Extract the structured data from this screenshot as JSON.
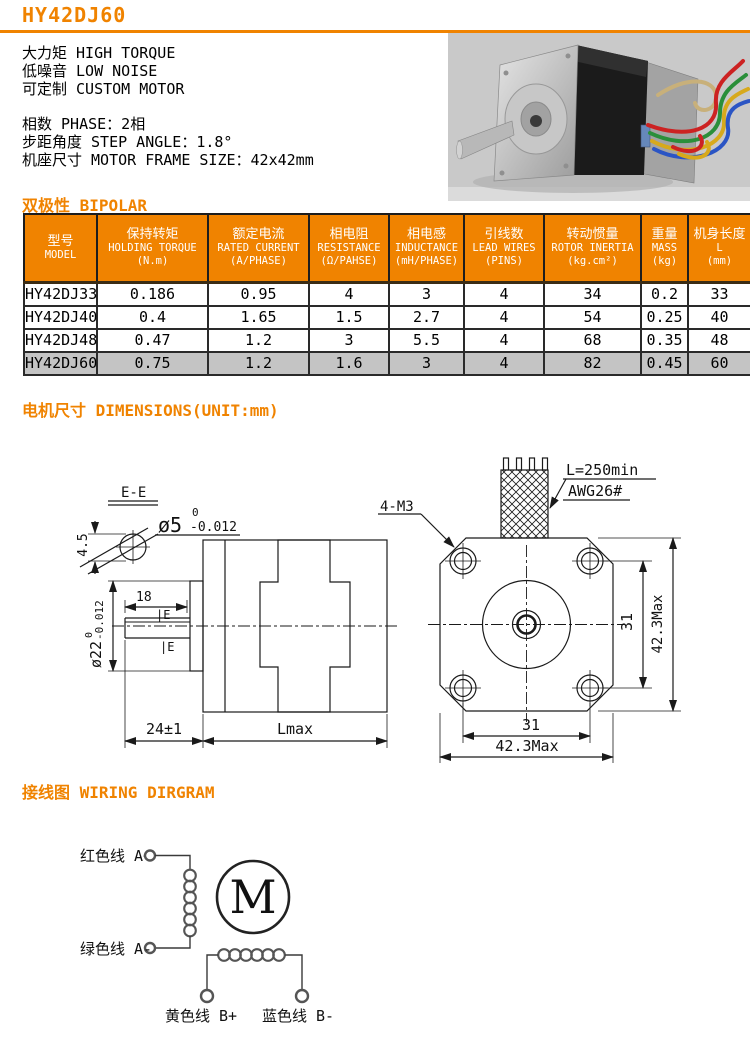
{
  "page": {
    "title": "HY42DJ60"
  },
  "intro": {
    "features": [
      "大力矩 HIGH TORQUE",
      "低噪音 LOW NOISE",
      "可定制 CUSTOM MOTOR"
    ],
    "specs": [
      "相数 PHASE：2相",
      "步距角度 STEP ANGLE：1.8°",
      "机座尺寸 MOTOR FRAME SIZE：42x42mm"
    ]
  },
  "sections": {
    "bipolar": "双极性 BIPOLAR",
    "dimensions": "电机尺寸 DIMENSIONS(UNIT:mm)",
    "wiring": "接线图 WIRING DIRGRAM"
  },
  "spec_table": {
    "columns": [
      {
        "cn": "型号",
        "en": "MODEL",
        "unit": ""
      },
      {
        "cn": "保持转矩",
        "en": "HOLDING TORQUE",
        "unit": "(N.m)"
      },
      {
        "cn": "额定电流",
        "en": "RATED CURRENT",
        "unit": "(A/PHASE)"
      },
      {
        "cn": "相电阻",
        "en": "RESISTANCE",
        "unit": "(Ω/PAHSE)"
      },
      {
        "cn": "相电感",
        "en": "INDUCTANCE",
        "unit": "(mH/PHASE)"
      },
      {
        "cn": "引线数",
        "en": "LEAD WIRES",
        "unit": "(PINS)"
      },
      {
        "cn": "转动惯量",
        "en": "ROTOR INERTIA",
        "unit": "(kg.cm²)"
      },
      {
        "cn": "重量",
        "en": "MASS",
        "unit": "(kg)"
      },
      {
        "cn": "机身长度",
        "en": "L",
        "unit": "(mm)"
      }
    ],
    "rows": [
      {
        "cells": [
          "HY42DJ33",
          "0.186",
          "0.95",
          "4",
          "3",
          "4",
          "34",
          "0.2",
          "33"
        ],
        "highlight": false
      },
      {
        "cells": [
          "HY42DJ40",
          "0.4",
          "1.65",
          "1.5",
          "2.7",
          "4",
          "54",
          "0.25",
          "40"
        ],
        "highlight": false
      },
      {
        "cells": [
          "HY42DJ48",
          "0.47",
          "1.2",
          "3",
          "5.5",
          "4",
          "68",
          "0.35",
          "48"
        ],
        "highlight": false
      },
      {
        "cells": [
          "HY42DJ60",
          "0.75",
          "1.2",
          "1.6",
          "3",
          "4",
          "82",
          "0.45",
          "60"
        ],
        "highlight": true
      }
    ]
  },
  "drawing": {
    "section_label": "E-E",
    "shaft_dia": "ø5",
    "shaft_tol_hi": "0",
    "shaft_tol_lo": "-0.012",
    "flat_height": "4.5",
    "boss_dia": "ø22",
    "boss_tol_hi": "0",
    "boss_tol_lo": "-0.012",
    "flat_length": "18",
    "datum_flag": "|E",
    "shaft_length": "24±1",
    "body_length": "Lmax",
    "mount_holes": "4-M3",
    "lead_length": "L=250min",
    "lead_gauge": "AWG26#",
    "hole_pitch": "31",
    "frame_size": "42.3Max"
  },
  "wiring": {
    "phase_a_pos": "红色线 A+",
    "phase_a_neg": "绿色线 A-",
    "phase_b_pos": "黄色线 B+",
    "phase_b_neg": "蓝色线 B-",
    "motor_symbol": "M"
  },
  "colors": {
    "accent": "#F08300",
    "highlight_row": "#C4C4C4",
    "photo_background": "#C9C9C9",
    "line": "#1A1A1A",
    "wire_colors": [
      "#CC2222",
      "#2A8F3A",
      "#2B55C4",
      "#D7A91C"
    ]
  }
}
